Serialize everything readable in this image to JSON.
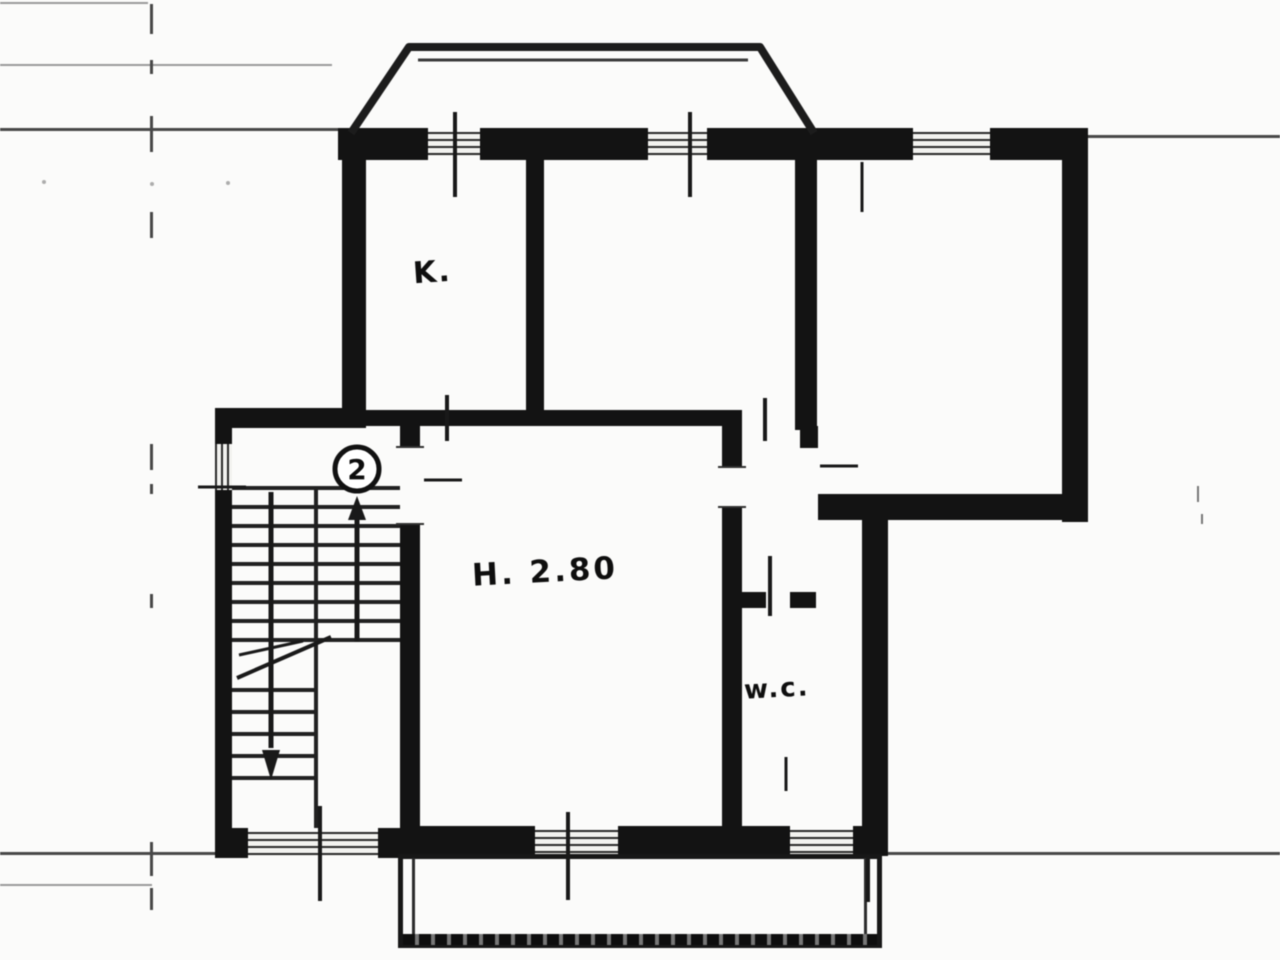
{
  "document": {
    "floor_number": "2",
    "annotations": {
      "kitchen_label": "K.",
      "ceiling_height_label": "H. 2.80",
      "wc_label": "w.c."
    }
  },
  "colors": {
    "background": "#fbfbfa",
    "wall_ink": "#161616",
    "thin_line_ink": "#4a4a4a",
    "window_hatch_ink": "#2c2c2c",
    "paper": "#ffffff"
  }
}
